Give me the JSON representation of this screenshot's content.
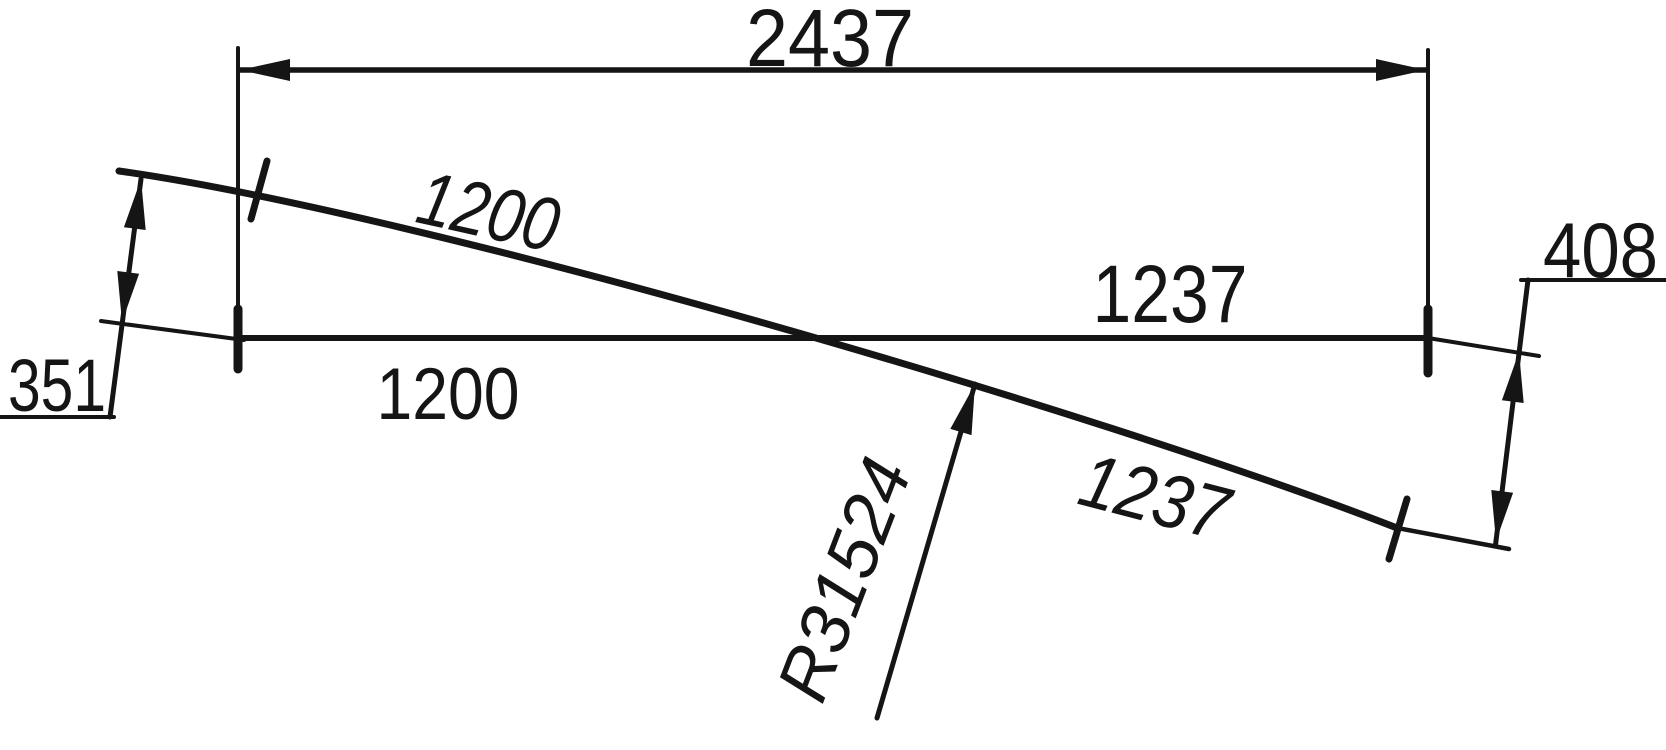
{
  "drawing": {
    "type": "technical-dimension-drawing",
    "colors": {
      "background": "#ffffff",
      "ink": "#151515"
    },
    "dimensions": {
      "total_span": "2437",
      "left_rise": "351",
      "right_drop": "408",
      "arc_segment_left": "1200",
      "arc_segment_right": "1237",
      "base_segment_left": "1200",
      "base_segment_right": "1237",
      "radius": "R31524"
    }
  }
}
